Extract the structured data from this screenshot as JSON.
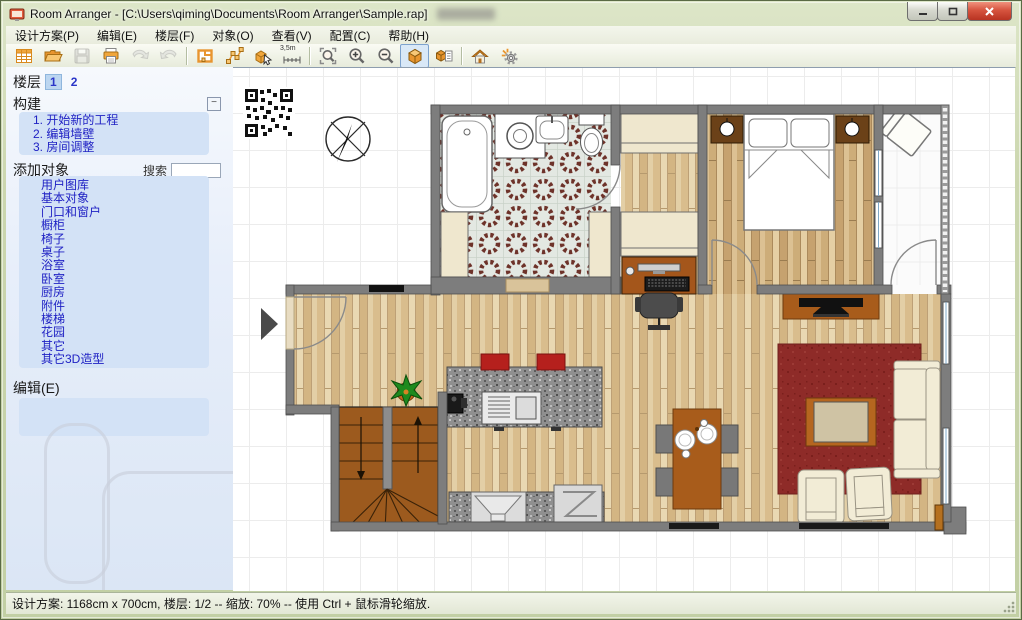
{
  "window": {
    "title": "Room Arranger - [C:\\Users\\qiming\\Documents\\Room Arranger\\Sample.rap]"
  },
  "menu": {
    "items": [
      {
        "label": "设计方案(P)"
      },
      {
        "label": "编辑(E)"
      },
      {
        "label": "楼层(F)"
      },
      {
        "label": "对象(O)"
      },
      {
        "label": "查看(V)"
      },
      {
        "label": "配置(C)"
      },
      {
        "label": "帮助(H)"
      }
    ]
  },
  "toolbar": {
    "measure_label": "3,5m",
    "buttons": [
      {
        "name": "new-project",
        "icon": "grid-document-icon",
        "disabled": false
      },
      {
        "name": "open",
        "icon": "folder-icon",
        "disabled": false
      },
      {
        "name": "save",
        "icon": "floppy-icon",
        "disabled": true
      },
      {
        "name": "print",
        "icon": "printer-icon",
        "disabled": false
      },
      {
        "name": "undo",
        "icon": "undo-arrow-icon",
        "disabled": true
      },
      {
        "name": "redo",
        "icon": "redo-arrow-icon",
        "disabled": true
      },
      {
        "name": "edit-walls",
        "icon": "floorplan-icon",
        "disabled": false
      },
      {
        "name": "edit-points",
        "icon": "vertices-icon",
        "disabled": false
      },
      {
        "name": "insert-object",
        "icon": "box-cursor-icon",
        "disabled": false
      },
      {
        "name": "measure",
        "icon": "ruler-icon",
        "disabled": false
      },
      {
        "name": "zoom-fit",
        "icon": "magnifier-brackets-icon",
        "disabled": false
      },
      {
        "name": "zoom-in",
        "icon": "magnifier-plus-icon",
        "disabled": false
      },
      {
        "name": "zoom-out",
        "icon": "magnifier-minus-icon",
        "disabled": false
      },
      {
        "name": "view-3d",
        "icon": "cube-icon",
        "disabled": false,
        "active": true
      },
      {
        "name": "view-3d-list",
        "icon": "cube-list-icon",
        "disabled": false
      },
      {
        "name": "home-web",
        "icon": "house-icon",
        "disabled": false
      },
      {
        "name": "settings-run",
        "icon": "gear-spark-icon",
        "disabled": false
      }
    ],
    "accent_color": "#f0a63c"
  },
  "sidebar": {
    "floors": {
      "label": "楼层",
      "tabs": [
        "1",
        "2"
      ],
      "active_tab": "1"
    },
    "build": {
      "label": "构建",
      "collapse_glyph": "−",
      "steps": [
        "1. 开始新的工程",
        "2. 编辑墙壁",
        "3. 房间调整"
      ]
    },
    "add_objects": {
      "label": "添加对象",
      "search_label": "搜索",
      "search_value": "",
      "categories": [
        "用户图库",
        "基本对象",
        "门口和窗户",
        "橱柜",
        "椅子",
        "桌子",
        "浴室",
        "卧室",
        "厨房",
        "附件",
        "楼梯",
        "花园",
        "其它",
        "其它3D造型"
      ]
    },
    "edit": {
      "label": "编辑(E)"
    }
  },
  "statusbar": {
    "text": "设计方案: 1168cm x 700cm, 楼层: 1/2 -- 缩放: 70% -- 使用 Ctrl + 鼠标滑轮缩放."
  },
  "colors": {
    "aero_frame": "#cbd6ae",
    "sidebar_panel": "#d3e2f6",
    "sidebar_link": "#2022c4",
    "toolbar_orange": "#f0a63c",
    "wall_gray": "#7d7d7d",
    "rug_red": "#8e2b28",
    "wood_floor": "#e3cfa6",
    "furniture_brown": "#a85c1b",
    "cream_furniture": "#f2ecd6"
  }
}
